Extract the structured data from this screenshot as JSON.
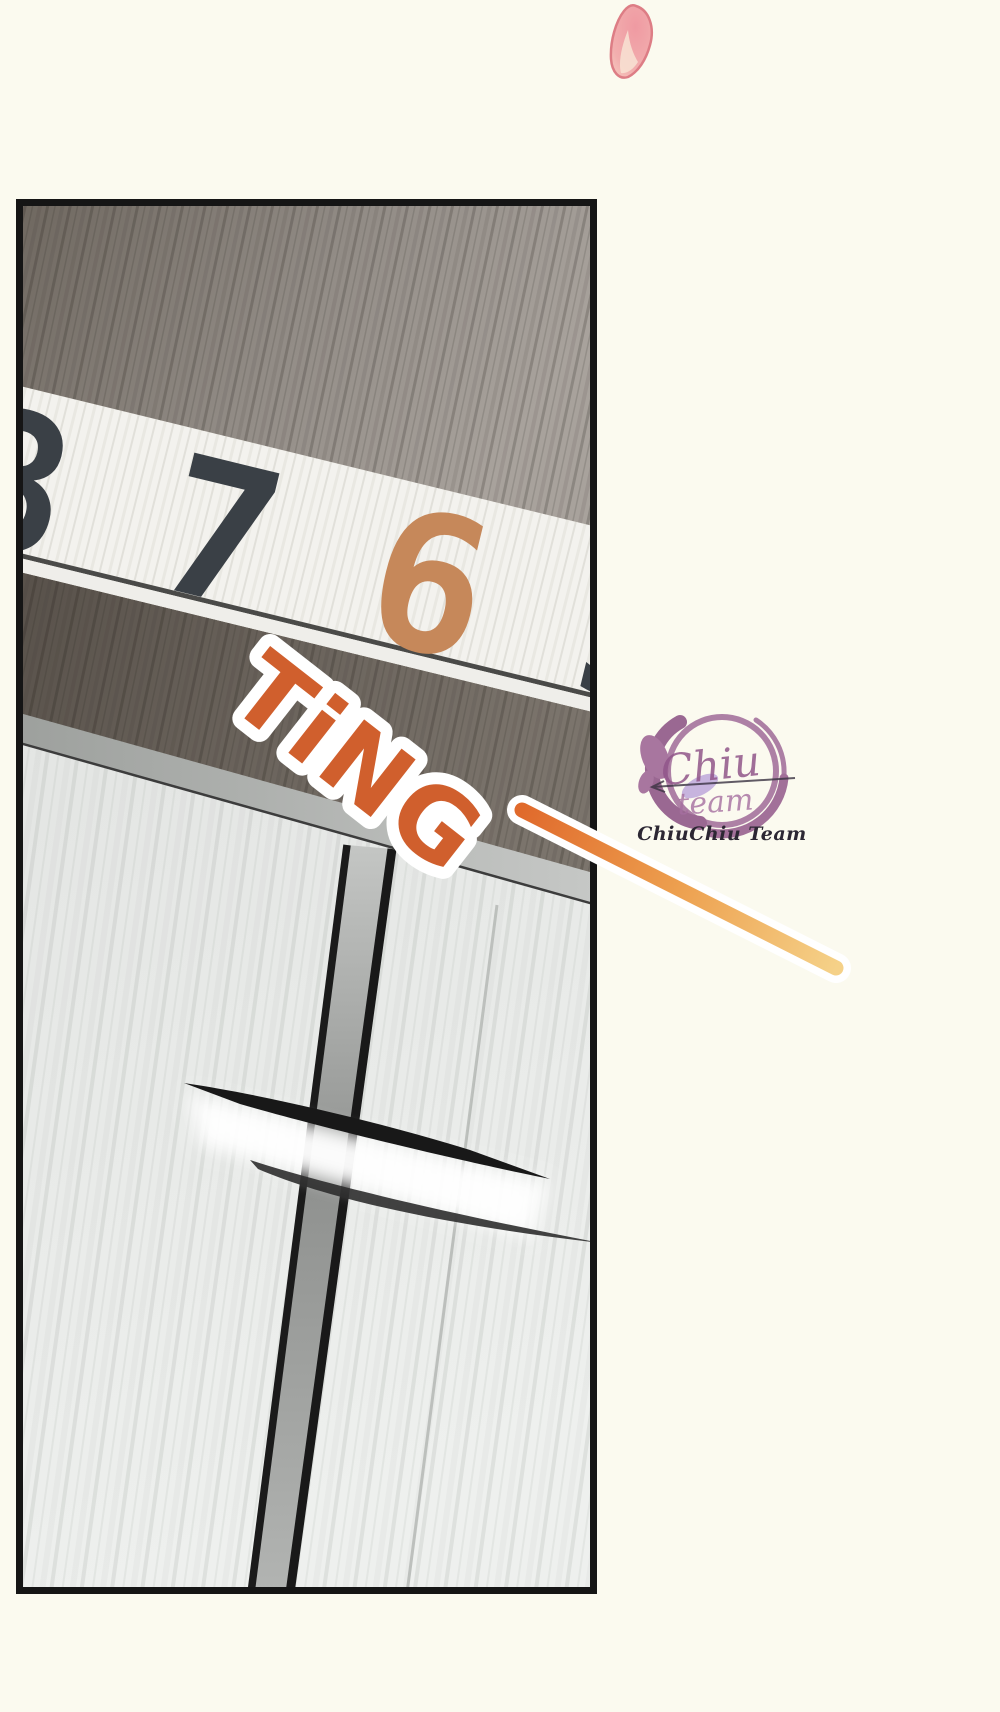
{
  "page": {
    "background_color": "#fbfaef"
  },
  "panel": {
    "description": "comic panel of elevator doors with floor indicator",
    "border_color": "#151515",
    "indicator": {
      "digits": [
        "8",
        "7",
        "6",
        "5",
        "4",
        "3"
      ],
      "active_digit": "6",
      "digit_color": "#3a4046",
      "active_color": "#c6885a",
      "strip_color": "#f3f2ee"
    },
    "sfx": {
      "text": "TiNG",
      "fill": "#d05f2d",
      "outline": "#ffffff"
    }
  },
  "watermark": {
    "script_line1": "Chiu",
    "script_line2": "team",
    "team_name": "ChiuChiu Team",
    "ring_color": "#9a5f92",
    "text_color": "#2c2733"
  },
  "decor": {
    "petal_color": "#ef9aa2",
    "beam_start_color": "#e06a2c",
    "beam_end_color": "#f5d188"
  }
}
